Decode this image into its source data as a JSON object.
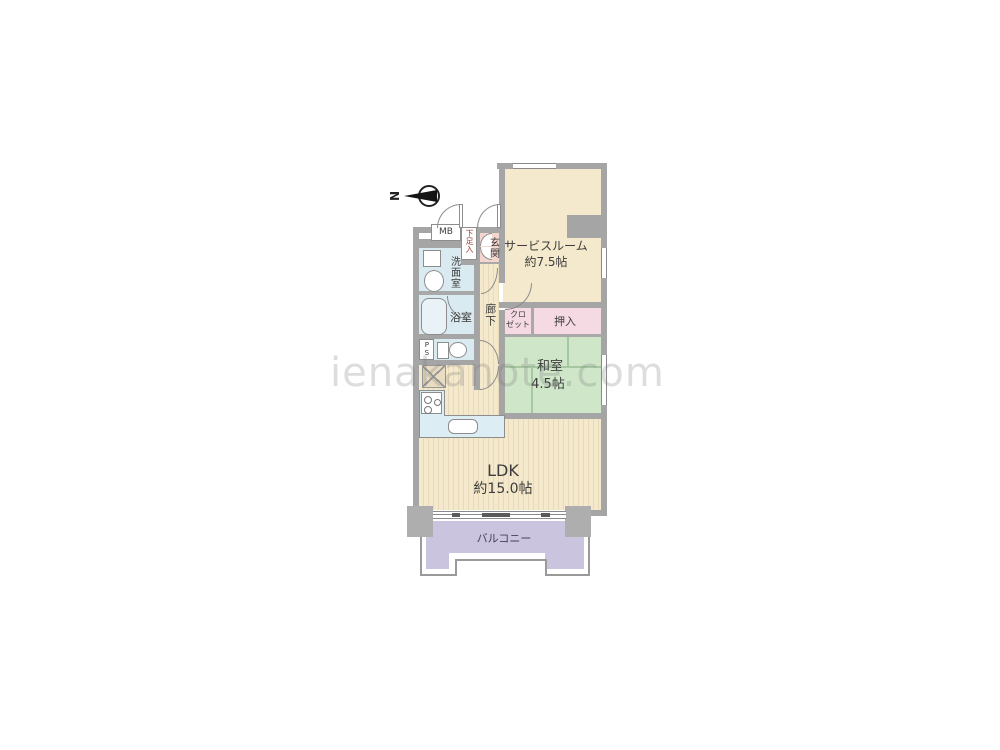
{
  "watermark": {
    "text": "ienakanote.com"
  },
  "compass": {
    "label": "N"
  },
  "rooms": {
    "service": {
      "name": "サービスルーム",
      "size": "約7.5帖"
    },
    "washitsu": {
      "name": "和室",
      "size": "4.5帖"
    },
    "ldk": {
      "name": "LDK",
      "size": "約15.0帖"
    },
    "balcony": {
      "name": "バルコニー"
    },
    "genkan": {
      "name": "玄関"
    },
    "corridor": {
      "name": "廊下"
    },
    "senmen": {
      "name": "洗面室"
    },
    "bath": {
      "name": "浴室"
    },
    "closet": {
      "line1": "クロ",
      "line2": "ゼット"
    },
    "oshiire": {
      "name": "押入"
    },
    "shoebox": {
      "name": "下足入"
    },
    "mb": {
      "name": "MB"
    },
    "ps": {
      "name": "PS"
    }
  },
  "palette": {
    "wall": "#a5a5a5",
    "flooring": "#f4e9cc",
    "flooring_stripe": "#e8dab6",
    "tatami": "#cfe6c9",
    "tatami_line": "#a6c8a0",
    "wet_area_blue": "#d9eaf1",
    "genkan_pink": "#f2d6cf",
    "closet_pink": "#f6dae3",
    "balcony_purple": "#cbc4de",
    "text": "#3c3c3c",
    "shoebox_text": "#9c4438",
    "watermark_gray": "#bdbdbd"
  }
}
